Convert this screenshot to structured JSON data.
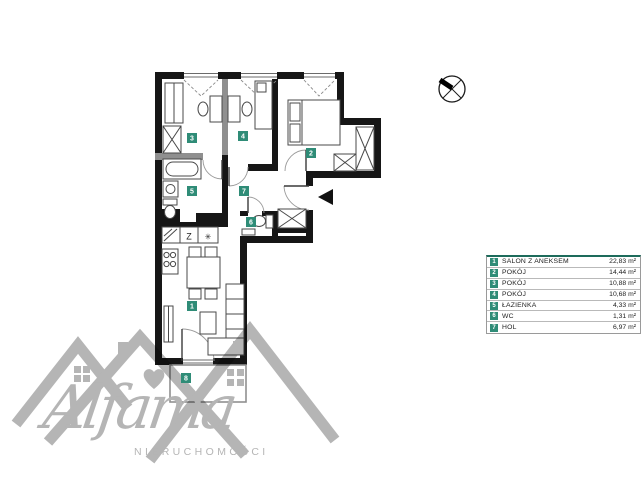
{
  "legend": {
    "rows": [
      {
        "num": "1",
        "label": "SALON Z ANEKSEM",
        "area": "22,83 m²"
      },
      {
        "num": "2",
        "label": "POKÓJ",
        "area": "14,44 m²"
      },
      {
        "num": "3",
        "label": "POKÓJ",
        "area": "10,88 m²"
      },
      {
        "num": "4",
        "label": "POKÓJ",
        "area": "10,68 m²"
      },
      {
        "num": "5",
        "label": "ŁAZIENKA",
        "area": "4,33 m²"
      },
      {
        "num": "6",
        "label": "WC",
        "area": "1,31 m²"
      },
      {
        "num": "7",
        "label": "HOL",
        "area": "6,97 m²"
      }
    ]
  },
  "plan": {
    "room_badges": {
      "salon": "1",
      "pokoj_right": "2",
      "pokoj_left": "3",
      "pokoj_mid": "4",
      "lazienka": "5",
      "wc": "6",
      "hol": "7",
      "balkon": "8"
    },
    "kitchen": {
      "sink_label": "Z",
      "fridge_symbol": "✳"
    }
  },
  "brand": {
    "name": "Alfama",
    "subtitle": "NIERUCHOMOŚCI"
  },
  "colors": {
    "badge_teal": "#2F8C77",
    "legend_accent": "#1D6B5B",
    "wall_black": "#161616",
    "watermark_gray": "#b5b5b5"
  }
}
